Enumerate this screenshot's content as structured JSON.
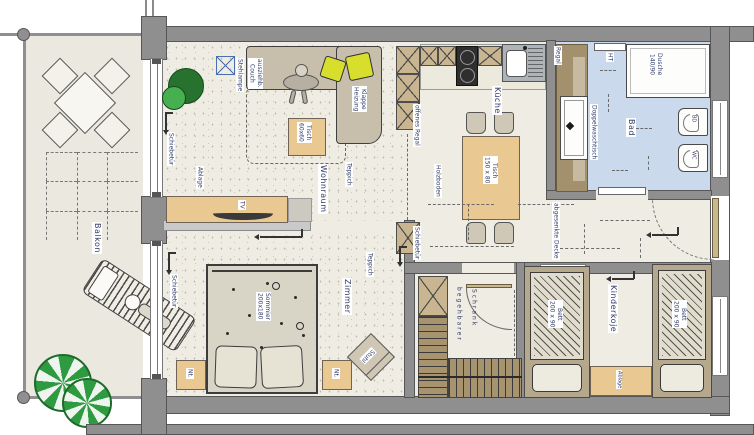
{
  "title": "Wohnungsgrundriss (floor plan)",
  "colors": {
    "wall": "#8f8f8f",
    "ink": "#2e3a68",
    "floor": "#efece3",
    "balcony_floor": "#ebe8df",
    "bath_floor": "#cbd9ec",
    "wood": "#e9c892",
    "couch": "#c7beac",
    "bed": "#d9d5c6",
    "stairs": "#a7946f",
    "tree_green": "#2f9b41",
    "pillow_yellow": "#d7de2c"
  },
  "rooms": {
    "balkon": {
      "name": "Balkon"
    },
    "wohnraum": {
      "name": "Wohnraum",
      "stehlampe": "Stehlampe",
      "couch_l1": "ausziehb.",
      "couch_l2": "Couch",
      "heizung_l1": "Klappe",
      "heizung_l2": "Heizung",
      "tisch_l1": "Tisch",
      "tisch_l2": "60x60",
      "teppich": "Teppich",
      "ablage": "Ablage",
      "tv": "TV",
      "schiebetuer": "Schiebetür"
    },
    "kueche": {
      "name": "Küche",
      "offenes_regal": "offenes Regal",
      "holzboden": "Holzboden",
      "tisch_l1": "Tisch",
      "tisch_l2": "150 x 80",
      "schiebetuer": "Schiebetür"
    },
    "bad": {
      "name": "Bad",
      "dusche_l1": "Dusche",
      "dusche_l2": "140/90",
      "waschtisch": "Doppelwaschtisch",
      "regal": "Regal",
      "ht": "HT",
      "bd": "BD",
      "wc": "WC"
    },
    "flur": {
      "decke": "abgesenkte Decke"
    },
    "zimmer": {
      "name": "Zimmer",
      "bett_l1": "Sommier",
      "bett_l2": "200x180",
      "nachttisch": "Nt.",
      "stuhl": "Stuhl",
      "teppich": "Teppich",
      "schiebetuer": "Schiebetür"
    },
    "schrank": {
      "l1": "begehbarer",
      "l2": "Schrank"
    },
    "kinderkoje": {
      "name": "Kinderkoje",
      "bett_l1": "Bett",
      "bett_l2": "200 x 90",
      "ablage": "Ablage"
    }
  }
}
